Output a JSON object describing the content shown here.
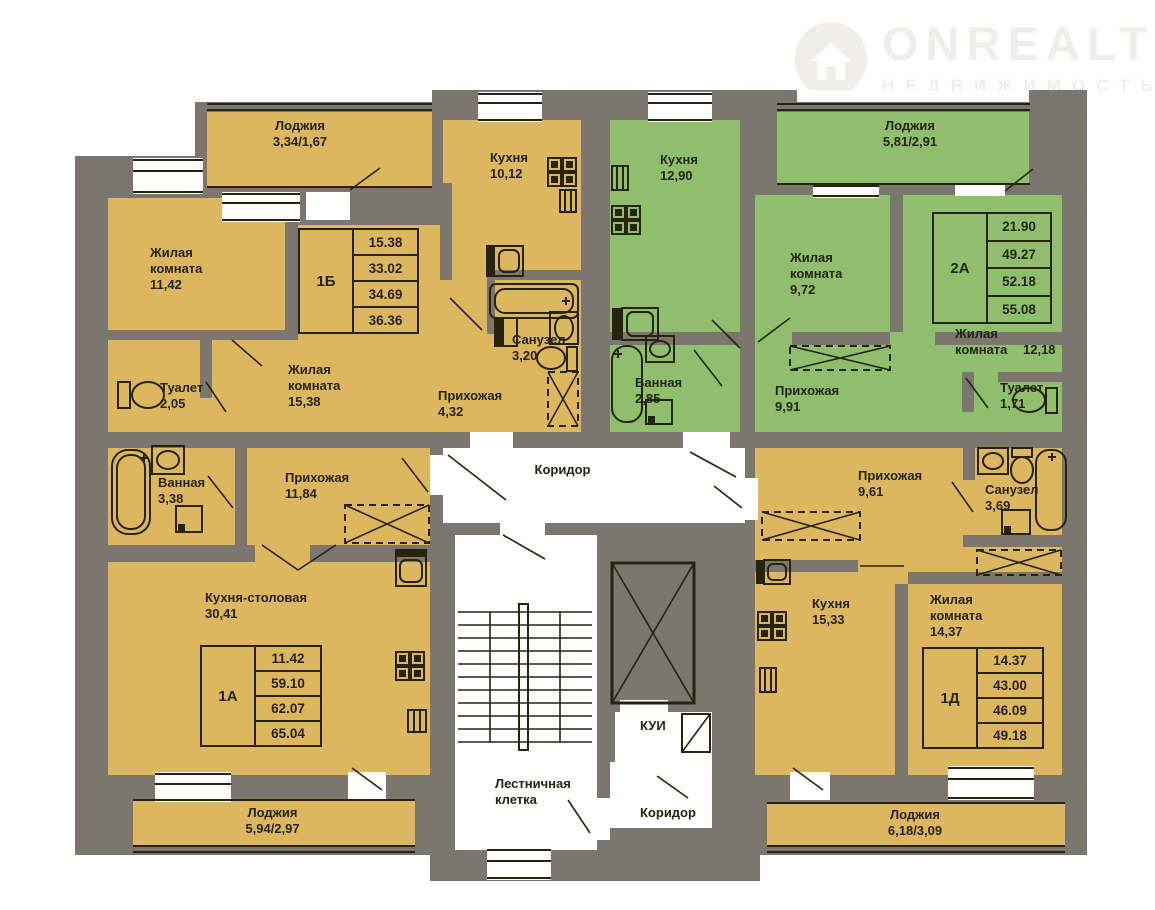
{
  "watermark": {
    "brand": "ONREALT",
    "tagline": "НЕДВИЖИМОСТЬ"
  },
  "common": {
    "corridor": "Коридор",
    "corridor_lower": "Коридор",
    "stairwell": "Лестничная клетка",
    "utility": "КУИ"
  },
  "apartments": {
    "a1b": {
      "label": "1Б",
      "areas": [
        "15.38",
        "33.02",
        "34.69",
        "36.36"
      ],
      "rooms": {
        "loggia": {
          "name": "Лоджия",
          "area": "3,34/1,67"
        },
        "living1": {
          "name": "Жилая комната",
          "area": "11,42"
        },
        "kitchen": {
          "name": "Кухня",
          "area": "10,12"
        },
        "living2": {
          "name": "Жилая комната",
          "area": "15,38"
        },
        "toilet": {
          "name": "Туалет",
          "area": "2,05"
        },
        "bathroom": {
          "name": "Санузел",
          "area": "3,20"
        },
        "hall": {
          "name": "Прихожая",
          "area": "4,32"
        }
      }
    },
    "a2a": {
      "label": "2А",
      "areas": [
        "21.90",
        "49.27",
        "52.18",
        "55.08"
      ],
      "rooms": {
        "kitchen": {
          "name": "Кухня",
          "area": "12,90"
        },
        "loggia": {
          "name": "Лоджия",
          "area": "5,81/2,91"
        },
        "living1": {
          "name": "Жилая комната",
          "area": "9,72"
        },
        "living2": {
          "name": "Жилая комната",
          "area": "12,18"
        },
        "bath": {
          "name": "Ванная",
          "area": "2,85"
        },
        "hall": {
          "name": "Прихожая",
          "area": "9,91"
        },
        "toilet": {
          "name": "Туалет",
          "area": "1,71"
        }
      }
    },
    "a1a": {
      "label": "1А",
      "areas": [
        "11.42",
        "59.10",
        "62.07",
        "65.04"
      ],
      "rooms": {
        "bath": {
          "name": "Ванная",
          "area": "3,38"
        },
        "hall": {
          "name": "Прихожая",
          "area": "11,84"
        },
        "kitchen_dining": {
          "name": "Кухня-столовая",
          "area": "30,41"
        },
        "loggia": {
          "name": "Лоджия",
          "area": "5,94/2,97"
        }
      }
    },
    "a1d": {
      "label": "1Д",
      "areas": [
        "14.37",
        "43.00",
        "46.09",
        "49.18"
      ],
      "rooms": {
        "hall": {
          "name": "Прихожая",
          "area": "9,61"
        },
        "bathroom": {
          "name": "Санузел",
          "area": "3,69"
        },
        "kitchen": {
          "name": "Кухня",
          "area": "15,33"
        },
        "living": {
          "name": "Жилая комната",
          "area": "14,37"
        },
        "loggia": {
          "name": "Лоджия",
          "area": "6,18/3,09"
        }
      }
    }
  },
  "icons": {
    "bathtub": "bathtub-icon",
    "toilet": "toilet-icon",
    "sink": "sink-icon",
    "kitchen_sink": "kitchen-sink-icon",
    "stove": "stove-icon",
    "washer": "washer-icon",
    "radiator": "radiator-icon",
    "wardrobe": "wardrobe-dashed-icon",
    "elevator": "elevator-shaft-icon",
    "stairs": "stairs-icon",
    "logo_pin": "brand-pin-icon"
  },
  "colors": {
    "wall": "#7c766e",
    "apartment_yellow": "#dcb75f",
    "apartment_green": "#8fbe6c",
    "line": "#26240f",
    "watermark": "#efeeeb",
    "background": "#ffffff"
  }
}
